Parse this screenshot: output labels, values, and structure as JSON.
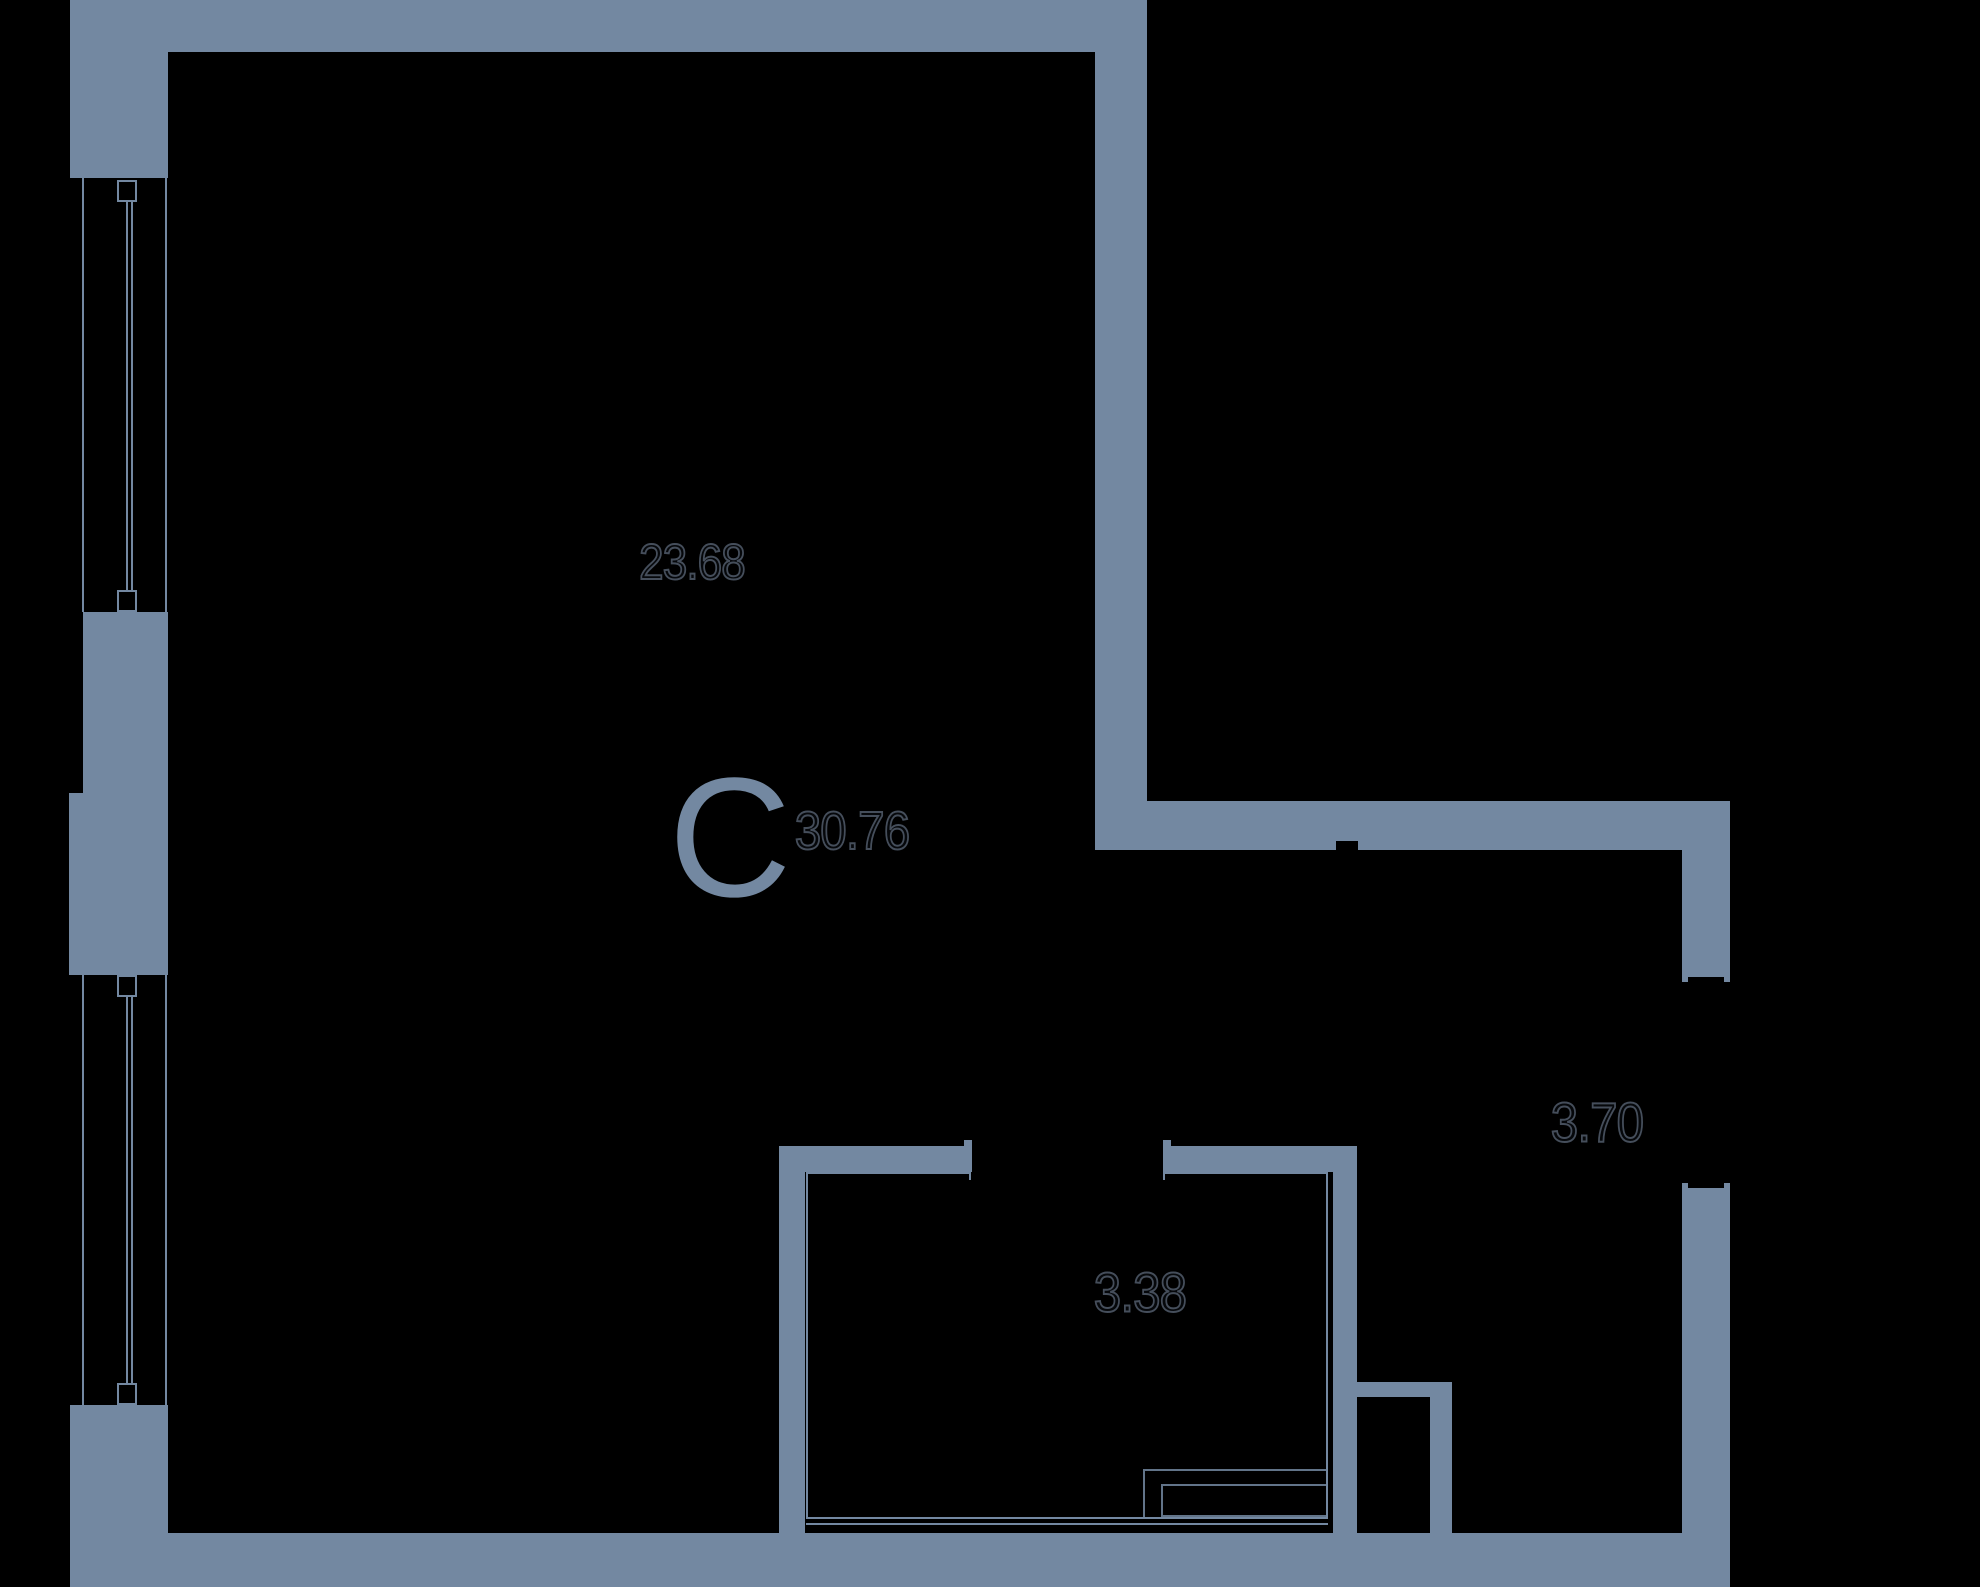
{
  "plan": {
    "unit_letter": "С",
    "areas": {
      "main_room": "23.68",
      "total": "30.76",
      "hallway": "3.70",
      "bathroom": "3.38"
    }
  },
  "colors": {
    "wall": "#7388A1",
    "background": "#000000",
    "area_text_outline": "#454e5b",
    "area_text_fill": "#05070a"
  }
}
